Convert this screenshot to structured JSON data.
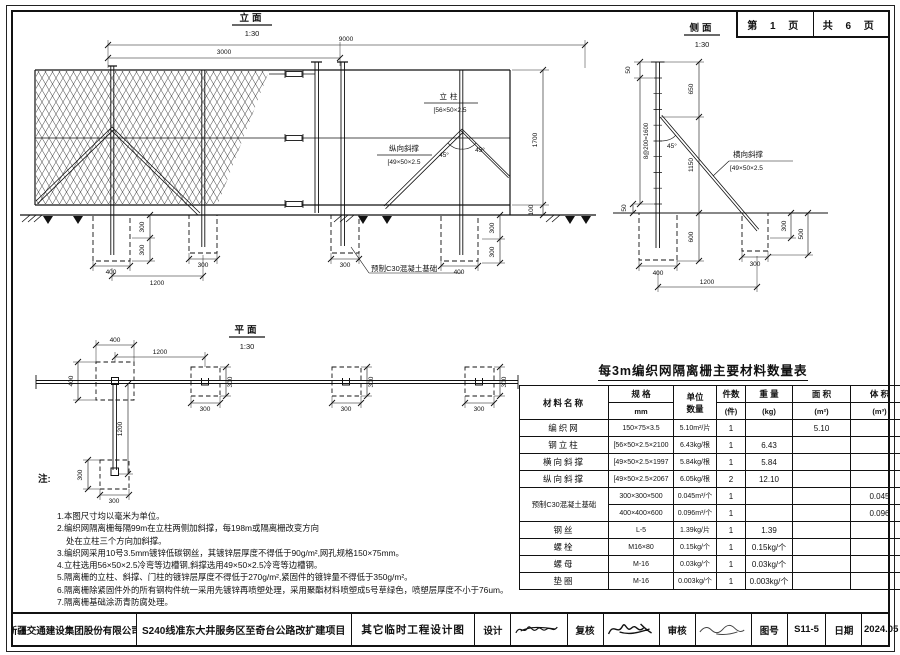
{
  "page_box": {
    "current": "第 1 页",
    "total": "共 6 页"
  },
  "elevation": {
    "title": "立面",
    "scale": "1:30",
    "dim_span": "9000",
    "dim_panel": "3000",
    "dim_height": "1700",
    "dim_rail_gap": "100",
    "dim_depth_a": "300",
    "dim_depth_b": "300",
    "dim_depth_right_a": "300",
    "dim_depth_right_b": "300",
    "dim_found1_width": "400",
    "dim_found_spacing": "1200",
    "dim_found2_width": "300",
    "dim_found3_width": "300",
    "dim_found4_width": "400",
    "post_label": "立柱",
    "post_spec": "[56×50×2.5",
    "brace_label": "纵向斜撑",
    "brace_spec": "[49×50×2.5",
    "angle_left": "45°",
    "angle_right": "45°",
    "foundation_label": "预制C30混凝土基础"
  },
  "side": {
    "title": "侧面",
    "scale": "1:30",
    "dim_cap": "50",
    "dim_holes": "8@200=1600",
    "dim_top": "650",
    "dim_mid": "1150",
    "angle": "45°",
    "brace_label": "横向斜撑",
    "brace_spec": "[49×50×2.5",
    "dim_embed": "50",
    "dim_found_left": "400",
    "dim_depth": "600",
    "dim_found_right": "300",
    "dim_spacing": "1200",
    "dim_right_a": "300",
    "dim_right_b": "500"
  },
  "plan": {
    "title": "平面",
    "scale": "1:30",
    "dim_sq1_w": "400",
    "dim_sq1_h": "400",
    "dim_spacing": "1200",
    "dim_sq2_w": "300",
    "dim_sq2_h": "300",
    "dim_sq3_w": "300",
    "dim_sq3_h": "300",
    "dim_sq4_w": "300",
    "dim_sq4_h": "300",
    "dim_stem": "1200",
    "dim_sq5_w": "300",
    "dim_sq5_h": "300"
  },
  "notes": {
    "label": "注:",
    "lines": [
      "1.本图尺寸均以毫米为单位。",
      "2.编织网隔离栅每隔99m在立柱两侧加斜撑，每198m或隔离栅改变方向",
      "处在立柱三个方向加斜撑。",
      "3.编织网采用10号3.5mm镀锌低碳钢丝，其镀锌层厚度不得低于90g/m²,网孔规格150×75mm。",
      "4.立柱选用56×50×2.5冷弯等边槽钢,斜撑选用49×50×2.5冷弯等边槽钢。",
      "5.隔离栅的立柱、斜撑、门柱的镀锌层厚度不得低于270g/m²,紧固件的镀锌量不得低于350g/m²。",
      "6.隔离栅除紧固件外的所有钢构件统一采用先镀锌再喷塑处理，采用聚酯材料喷塑成5号草绿色，喷塑层厚度不小于76um。",
      "7.隔离栅基础涂沥青防腐处理。"
    ]
  },
  "table": {
    "title": "每3m编织网隔离栅主要材料数量表",
    "headers": {
      "material": "材料名称",
      "spec": "规 格",
      "spec_unit": "mm",
      "unit_qty_a": "单位",
      "unit_qty_b": "数量",
      "count": "件数",
      "count_unit": "(件)",
      "weight": "重 量",
      "weight_unit": "(kg)",
      "area": "面 积",
      "area_unit": "(m²)",
      "volume": "体 积",
      "volume_unit": "(m³)"
    },
    "rows": [
      {
        "name": "编织网",
        "spec": "150×75×3.5",
        "unit": "5.10m²/片",
        "count": "1",
        "weight": "",
        "area": "5.10",
        "volume": ""
      },
      {
        "name": "钢立柱",
        "spec": "[56×50×2.5×2100",
        "unit": "6.43kg/根",
        "count": "1",
        "weight": "6.43",
        "area": "",
        "volume": ""
      },
      {
        "name": "横向斜撑",
        "spec": "[49×50×2.5×1997",
        "unit": "5.84kg/根",
        "count": "1",
        "weight": "5.84",
        "area": "",
        "volume": ""
      },
      {
        "name": "纵向斜撑",
        "spec": "[49×50×2.5×2067",
        "unit": "6.05kg/根",
        "count": "2",
        "weight": "12.10",
        "area": "",
        "volume": ""
      },
      {
        "name": "预制C30混凝土基础",
        "spec": "300×300×500",
        "unit": "0.045m³/个",
        "count": "1",
        "weight": "",
        "area": "",
        "volume": "0.045"
      },
      {
        "name": "",
        "spec": "400×400×600",
        "unit": "0.096m³/个",
        "count": "1",
        "weight": "",
        "area": "",
        "volume": "0.096"
      },
      {
        "name": "钢丝",
        "spec": "L-5",
        "unit": "1.39kg/片",
        "count": "1",
        "weight": "1.39",
        "area": "",
        "volume": ""
      },
      {
        "name": "螺栓",
        "spec": "M16×80",
        "unit": "0.15kg/个",
        "count": "1",
        "weight": "0.15kg/个",
        "area": "",
        "volume": ""
      },
      {
        "name": "螺母",
        "spec": "M-16",
        "unit": "0.03kg/个",
        "count": "1",
        "weight": "0.03kg/个",
        "area": "",
        "volume": ""
      },
      {
        "name": "垫圈",
        "spec": "M-16",
        "unit": "0.003kg/个",
        "count": "1",
        "weight": "0.003kg/个",
        "area": "",
        "volume": ""
      }
    ]
  },
  "title_bar": {
    "company": "新疆交通建设集团股份有限公司",
    "project": "S240线准东大井服务区至奇台公路改扩建项目",
    "drawing_title": "其它临时工程设计图",
    "design_label": "设计",
    "check_label": "复核",
    "audit_label": "审核",
    "no_label": "图号",
    "drawing_no": "S11-5",
    "date_label": "日期",
    "date": "2024.05"
  }
}
